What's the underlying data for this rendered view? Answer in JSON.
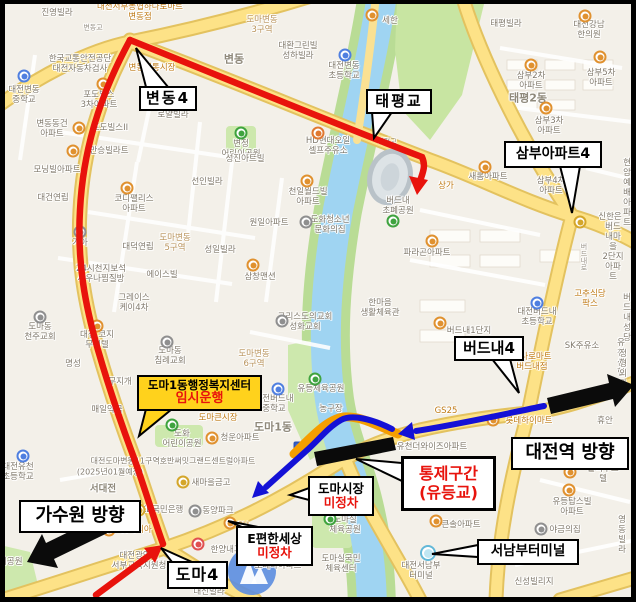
{
  "title": "버스 우회 안내 지도 (유등교 통제구간)",
  "colors": {
    "route_red": "#e8130c",
    "route_blue": "#1411d6",
    "detour_orange": "#f59e00",
    "closure_black": "#0a0a0a",
    "arrow_black": "#0b0b0b",
    "highlight_yellow": "#ffd21c",
    "road_yellow": "#fde287",
    "river_blue": "#9fd4f2",
    "park_green": "#bfe09b",
    "callout_red_text": "#e8130c"
  },
  "callouts": {
    "bendong4": {
      "label": "변동4"
    },
    "taepyeonggyo": {
      "label": "태평교"
    },
    "sambu": {
      "label": "삼부아파트4"
    },
    "beodeunae4": {
      "label": "버드내4"
    },
    "daejeon_station": {
      "label": "대전역 방향"
    },
    "gasuwon": {
      "label": "가수원 방향"
    },
    "doma4": {
      "label": "도마4"
    },
    "seonambu_terminal": {
      "label": "서남부터미널"
    },
    "control_zone": {
      "line1": "통제구간",
      "line2": "(유등교)"
    },
    "doma_market": {
      "line1": "도마시장",
      "line2": "미정차"
    },
    "epyeonhansesang": {
      "line1": "E편한세상",
      "line2": "미정차"
    },
    "temp_service": {
      "line1": "도마1동행정복지센터",
      "line2": "임시운행"
    }
  },
  "map_labels": [
    {
      "t": "진영빌라",
      "x": 57,
      "y": 13
    },
    {
      "t": "대전서부농협하나로마트\n변동점",
      "x": 140,
      "y": 12,
      "c": "o"
    },
    {
      "t": "도마변동\n3구역",
      "x": 262,
      "y": 25,
      "c": "t"
    },
    {
      "t": "대환그린빌\n성하빌라",
      "x": 298,
      "y": 51
    },
    {
      "t": "변동",
      "x": 234,
      "y": 60,
      "c": "d"
    },
    {
      "t": "세한",
      "x": 390,
      "y": 21
    },
    {
      "t": "태평빌라",
      "x": 506,
      "y": 24
    },
    {
      "t": "대전강남\n한의원",
      "x": 589,
      "y": 30
    },
    {
      "t": "한국교통안전공단\n대전자동차검사",
      "x": 80,
      "y": 64
    },
    {
      "t": "변동전통시장",
      "x": 152,
      "y": 68,
      "c": "o"
    },
    {
      "t": "포도빌스\n3차아파트",
      "x": 99,
      "y": 100
    },
    {
      "t": "로얄빌라",
      "x": 173,
      "y": 115
    },
    {
      "t": "변동동건\n아파트",
      "x": 52,
      "y": 129
    },
    {
      "t": "포도빌스II",
      "x": 110,
      "y": 128
    },
    {
      "t": "대전변동\n중학교",
      "x": 24,
      "y": 95
    },
    {
      "t": "만승빌라트",
      "x": 109,
      "y": 151
    },
    {
      "t": "변정\n어린이공원",
      "x": 241,
      "y": 149
    },
    {
      "t": "성진아트빌",
      "x": 245,
      "y": 159
    },
    {
      "t": "HD현대오일\n셀프주유소",
      "x": 328,
      "y": 146
    },
    {
      "t": "대전변동\n초등학교",
      "x": 344,
      "y": 71
    },
    {
      "t": "삼부2차\n아파트",
      "x": 531,
      "y": 81
    },
    {
      "t": "삼부5차\n아파트",
      "x": 601,
      "y": 78
    },
    {
      "t": "태평2동",
      "x": 528,
      "y": 99,
      "c": "d"
    },
    {
      "t": "삼부3차\n아파트",
      "x": 549,
      "y": 126
    },
    {
      "t": "이벡스",
      "x": 636,
      "y": 146
    },
    {
      "t": "삼부4차\n아파트",
      "x": 551,
      "y": 186
    },
    {
      "t": "새롬아파트",
      "x": 488,
      "y": 177
    },
    {
      "t": "상가",
      "x": 446,
      "y": 186,
      "c": "o"
    },
    {
      "t": "버드내\n초폐공원",
      "x": 398,
      "y": 206
    },
    {
      "t": "현암예배\n아파트",
      "x": 627,
      "y": 193
    },
    {
      "t": "신한은행",
      "x": 610,
      "y": 222
    },
    {
      "t": "파라곤아파트",
      "x": 427,
      "y": 253
    },
    {
      "t": "버드내마을\n2단지아파트",
      "x": 613,
      "y": 252
    },
    {
      "t": "마라",
      "x": 638,
      "y": 260
    },
    {
      "t": "대명",
      "x": 637,
      "y": 277
    },
    {
      "t": "천일월드빌\n아파트",
      "x": 308,
      "y": 197
    },
    {
      "t": "선인빌라",
      "x": 207,
      "y": 182
    },
    {
      "t": "모닝빌아파트",
      "x": 57,
      "y": 170
    },
    {
      "t": "대건연립",
      "x": 53,
      "y": 198
    },
    {
      "t": "코디팰리스\n아파트",
      "x": 134,
      "y": 204
    },
    {
      "t": "원일아파트",
      "x": 269,
      "y": 223
    },
    {
      "t": "도화청소년\n문화의집",
      "x": 330,
      "y": 225
    },
    {
      "t": "도마변동\n5구역",
      "x": 175,
      "y": 243,
      "c": "t"
    },
    {
      "t": "대덕연립",
      "x": 138,
      "y": 247
    },
    {
      "t": "기아",
      "x": 80,
      "y": 243
    },
    {
      "t": "성일빌라",
      "x": 220,
      "y": 250
    },
    {
      "t": "에이스빌",
      "x": 162,
      "y": 275
    },
    {
      "t": "24시천지보석\n사우나찜질방",
      "x": 101,
      "y": 274
    },
    {
      "t": "그레이스\n케이4차",
      "x": 134,
      "y": 303
    },
    {
      "t": "삼창맨션",
      "x": 260,
      "y": 277
    },
    {
      "t": "도마동\n천주교회",
      "x": 40,
      "y": 332
    },
    {
      "t": "대전 코지\n무인텔",
      "x": 97,
      "y": 340
    },
    {
      "t": "도마동\n침례교회",
      "x": 170,
      "y": 356
    },
    {
      "t": "명성",
      "x": 73,
      "y": 364
    },
    {
      "t": "무지개",
      "x": 120,
      "y": 382
    },
    {
      "t": "매일약국",
      "x": 107,
      "y": 410
    },
    {
      "t": "그리스도의교회\n성화교회",
      "x": 305,
      "y": 322
    },
    {
      "t": "도마변동\n6구역",
      "x": 254,
      "y": 359,
      "c": "t"
    },
    {
      "t": "한마음\n생활체육관",
      "x": 380,
      "y": 308
    },
    {
      "t": "유등체육공원",
      "x": 321,
      "y": 389
    },
    {
      "t": "농구장",
      "x": 331,
      "y": 409
    },
    {
      "t": "대전버드내\n중학교",
      "x": 274,
      "y": 404
    },
    {
      "t": "도마큰시장",
      "x": 218,
      "y": 418,
      "c": "o"
    },
    {
      "t": "도화\n어린이공원",
      "x": 182,
      "y": 439
    },
    {
      "t": "청운아파트",
      "x": 240,
      "y": 438
    },
    {
      "t": "도마1동",
      "x": 273,
      "y": 428,
      "c": "d"
    },
    {
      "t": "유등탑스빌\n아파트",
      "x": 572,
      "y": 507
    },
    {
      "t": "큰솔아파트",
      "x": 442,
      "y": 489
    },
    {
      "t": "큰솔아파트",
      "x": 461,
      "y": 525
    },
    {
      "t": "야금의집",
      "x": 565,
      "y": 530
    },
    {
      "t": "영동빌라",
      "x": 622,
      "y": 535
    },
    {
      "t": "대진빌라",
      "x": 637,
      "y": 553
    },
    {
      "t": "대전서남부\n터미널",
      "x": 421,
      "y": 571
    },
    {
      "t": "신성빌리지",
      "x": 534,
      "y": 582
    },
    {
      "t": "도마실\n체육공원",
      "x": 345,
      "y": 525
    },
    {
      "t": "도마실국민\n체육센터",
      "x": 341,
      "y": 564
    },
    {
      "t": "대전유천\n초등학교",
      "x": 18,
      "y": 472
    },
    {
      "t": "서대전",
      "x": 103,
      "y": 489,
      "c": "d",
      "s": 9.5
    },
    {
      "t": "대전도마변동11구역호반써밋그랜드센트럴아파트",
      "x": 173,
      "y": 461,
      "s": 8
    },
    {
      "t": "(2025년01월예정)",
      "x": 110,
      "y": 472,
      "s": 8
    },
    {
      "t": "새마을금고",
      "x": 211,
      "y": 483
    },
    {
      "t": "KB국민은행",
      "x": 162,
      "y": 510
    },
    {
      "t": "동양파크",
      "x": 218,
      "y": 511
    },
    {
      "t": "롯데리아",
      "x": 136,
      "y": 530,
      "c": "o"
    },
    {
      "t": "한양내과의원",
      "x": 234,
      "y": 550
    },
    {
      "t": "CU",
      "x": 243,
      "y": 526,
      "c": "o"
    },
    {
      "t": "포레나아파트",
      "x": 278,
      "y": 566
    },
    {
      "t": "대신빌라",
      "x": 209,
      "y": 592
    },
    {
      "t": "대전광역시\n서부교육지원청",
      "x": 139,
      "y": 561
    },
    {
      "t": "어린이공원",
      "x": 3,
      "y": 562
    },
    {
      "t": "유천더와이즈아파트",
      "x": 432,
      "y": 447
    },
    {
      "t": "GS25",
      "x": 446,
      "y": 411,
      "c": "o"
    },
    {
      "t": "하나로마트\n버드내점",
      "x": 532,
      "y": 362,
      "c": "o"
    },
    {
      "t": "롯데하이마트",
      "x": 529,
      "y": 421,
      "c": "o"
    },
    {
      "t": "휴안",
      "x": 605,
      "y": 421
    },
    {
      "t": "세일",
      "x": 638,
      "y": 428
    },
    {
      "t": "졸리부스텔",
      "x": 603,
      "y": 474
    },
    {
      "t": "고추식당\n팍스",
      "x": 590,
      "y": 299,
      "c": "o"
    },
    {
      "t": "버드내성당",
      "x": 627,
      "y": 318
    },
    {
      "t": "SK주유소",
      "x": 582,
      "y": 346
    },
    {
      "t": "유천신협",
      "x": 621,
      "y": 358
    },
    {
      "t": "정형외과",
      "x": 623,
      "y": 369
    },
    {
      "t": "버드내1단지",
      "x": 469,
      "y": 331
    },
    {
      "t": "대전버드내\n초등학교",
      "x": 537,
      "y": 317
    },
    {
      "t": "변동교",
      "x": 93,
      "y": 28,
      "c": "rd"
    },
    {
      "t": "태평교",
      "x": 387,
      "y": 142,
      "c": "rd"
    },
    {
      "t": "버\n드\n내\n로",
      "x": 584,
      "y": 258,
      "c": "rd"
    }
  ],
  "pois": [
    {
      "x": 372,
      "y": 15,
      "k": "a"
    },
    {
      "x": 585,
      "y": 16,
      "k": "a"
    },
    {
      "x": 103,
      "y": 84,
      "k": "a"
    },
    {
      "x": 79,
      "y": 128,
      "k": "a"
    },
    {
      "x": 73,
      "y": 151,
      "k": "a"
    },
    {
      "x": 24,
      "y": 76,
      "k": "s"
    },
    {
      "x": 345,
      "y": 55,
      "k": "s"
    },
    {
      "x": 241,
      "y": 133,
      "k": "p"
    },
    {
      "x": 307,
      "y": 181,
      "k": "a"
    },
    {
      "x": 127,
      "y": 188,
      "k": "a"
    },
    {
      "x": 306,
      "y": 222,
      "k": "c"
    },
    {
      "x": 80,
      "y": 232,
      "k": "c"
    },
    {
      "x": 253,
      "y": 265,
      "k": "a"
    },
    {
      "x": 40,
      "y": 317,
      "k": "c"
    },
    {
      "x": 97,
      "y": 326,
      "k": "a"
    },
    {
      "x": 167,
      "y": 342,
      "k": "c"
    },
    {
      "x": 282,
      "y": 321,
      "k": "c"
    },
    {
      "x": 315,
      "y": 379,
      "k": "p"
    },
    {
      "x": 278,
      "y": 389,
      "k": "s"
    },
    {
      "x": 172,
      "y": 425,
      "k": "p"
    },
    {
      "x": 212,
      "y": 438,
      "k": "a"
    },
    {
      "x": 440,
      "y": 323,
      "k": "a"
    },
    {
      "x": 537,
      "y": 303,
      "k": "s"
    },
    {
      "x": 485,
      "y": 167,
      "k": "a"
    },
    {
      "x": 432,
      "y": 241,
      "k": "a"
    },
    {
      "x": 531,
      "y": 65,
      "k": "a"
    },
    {
      "x": 600,
      "y": 57,
      "k": "a"
    },
    {
      "x": 546,
      "y": 108,
      "k": "a"
    },
    {
      "x": 393,
      "y": 221,
      "k": "p"
    },
    {
      "x": 580,
      "y": 222,
      "k": "b"
    },
    {
      "x": 569,
      "y": 490,
      "k": "a"
    },
    {
      "x": 441,
      "y": 475,
      "k": "a"
    },
    {
      "x": 436,
      "y": 521,
      "k": "a"
    },
    {
      "x": 541,
      "y": 529,
      "k": "c"
    },
    {
      "x": 428,
      "y": 553,
      "k": "t"
    },
    {
      "x": 330,
      "y": 519,
      "k": "p"
    },
    {
      "x": 23,
      "y": 456,
      "k": "s"
    },
    {
      "x": 183,
      "y": 482,
      "k": "b"
    },
    {
      "x": 139,
      "y": 510,
      "k": "b"
    },
    {
      "x": 195,
      "y": 511,
      "k": "c"
    },
    {
      "x": 109,
      "y": 530,
      "k": "a"
    },
    {
      "x": 198,
      "y": 544,
      "k": "h"
    },
    {
      "x": 230,
      "y": 523,
      "k": "a"
    },
    {
      "x": 493,
      "y": 420,
      "k": "a"
    },
    {
      "x": 570,
      "y": 472,
      "k": "a"
    },
    {
      "x": 300,
      "y": 448,
      "k": "P",
      "g": "P"
    },
    {
      "x": 318,
      "y": 133,
      "k": "g"
    }
  ]
}
